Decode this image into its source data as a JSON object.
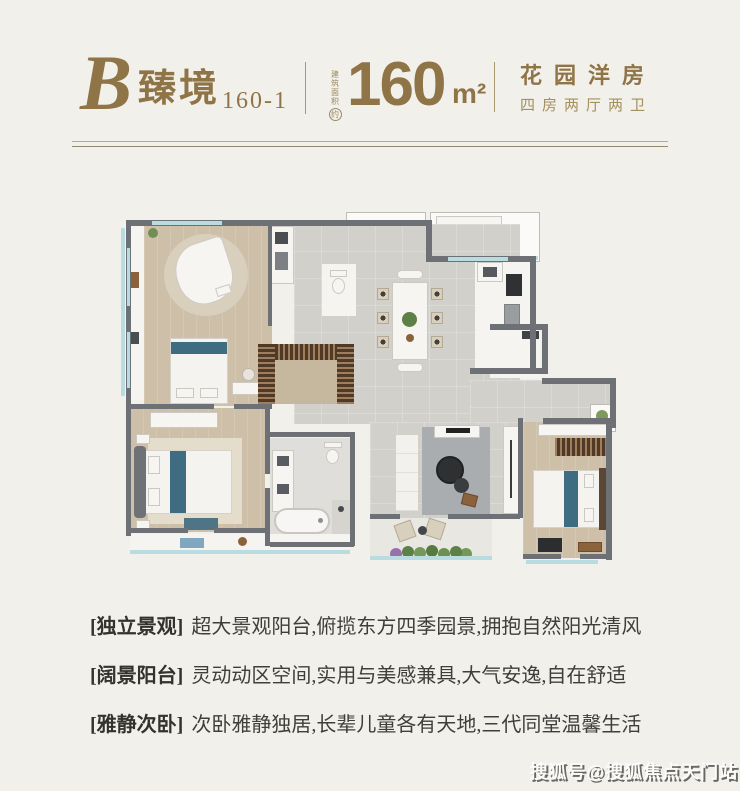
{
  "header": {
    "block_letter": "B",
    "name": "臻境",
    "unit_code": "160-1",
    "area_note_vertical": "建筑面积",
    "area_note_circled": "约",
    "area_value": "160",
    "area_unit": "m²",
    "type_title": "花园洋房",
    "type_subtitle": "四房两厅两卫"
  },
  "features": [
    {
      "label": "[独立景观]",
      "text": "超大景观阳台,俯揽东方四季园景,拥抱自然阳光清风"
    },
    {
      "label": "[阔景阳台]",
      "text": "灵动动区空间,实用与美感兼具,大气安逸,自在舒适"
    },
    {
      "label": "[雅静次卧]",
      "text": "次卧雅静独居,长辈儿童各有天地,三代同堂温馨生活"
    }
  ],
  "watermark": "搜狐号@搜狐焦点天门站",
  "colors": {
    "background": "#f2f0ea",
    "accent_gold": "#8e7446",
    "accent_gold_light": "#a3905f",
    "wall": "#6d7175",
    "wood_floor": "#cdbfa8",
    "tile_floor": "#d1d0cb",
    "balcony_glass": "#b9dce0",
    "bed_accent_teal": "#3e6d82",
    "closet_brown": "#6a4e34",
    "plant_green": "#6f8f55",
    "body_text": "#3f3e3c"
  }
}
